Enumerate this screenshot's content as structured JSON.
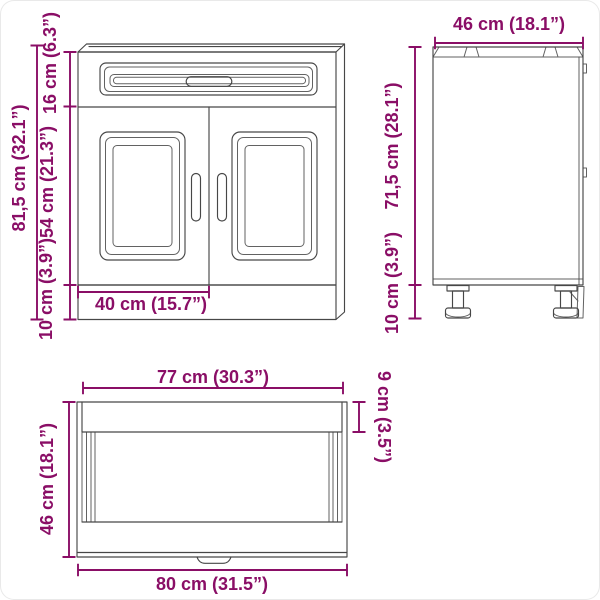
{
  "colors": {
    "dimension": "#8a0e66",
    "line": "#474747",
    "background": "#ffffff"
  },
  "front_view": {
    "total_height": "81,5 cm (32.1”)",
    "top_section_height": "16 cm (6.3”)",
    "middle_section_height": "54 cm (21.3”)",
    "bottom_section_height": "10 cm (3.9”)",
    "door_width": "40 cm (15.7”)"
  },
  "side_view": {
    "depth": "46 cm (18.1”)",
    "body_height": "71,5 cm (28.1”)",
    "leg_height": "10 cm (3.9”)"
  },
  "top_view": {
    "inner_width": "77 cm (30.3”)",
    "front_rail_depth": "9 cm (3.5”)",
    "depth": "46 cm (18.1”)",
    "total_width": "80 cm (31.5”)"
  }
}
